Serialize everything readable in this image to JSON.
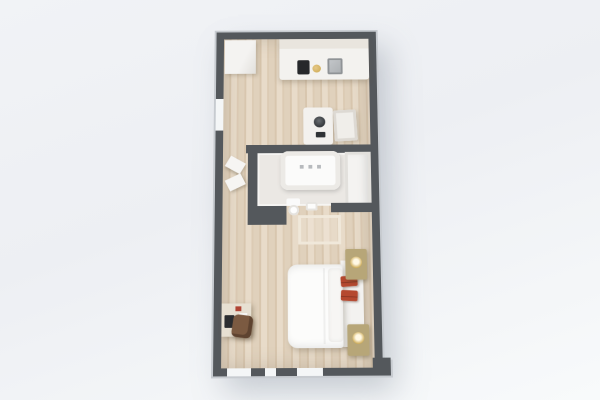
{
  "scene": {
    "title": "3D floor plan render",
    "type": "studio-apartment-top-down-3d",
    "view": "bird's-eye, slight perspective taper toward top"
  },
  "colors": {
    "bg": "#eff1f4",
    "wall": "#54585c",
    "wallEdge": "#c7cbd0",
    "wood": "#e0d1bc",
    "woodDark": "#d8c6ae",
    "woodLight": "#e8dbc9",
    "bathFloor": "#ebe8e4",
    "counter": "#f3f2ef",
    "cooktop": "#26282b",
    "appliance": "#a9adb0",
    "nightstand": "#b7a678",
    "lampGold": "#caa64e",
    "accentPillow": "#b5482f",
    "chairBrown": "#7b5a41"
  },
  "rooms": {
    "kitchen": {
      "name": "Kitchen / Dining",
      "items": [
        "tall wardrobe",
        "kitchen counter with upper cabinets",
        "black cooktop",
        "round brass sink",
        "stainless oven",
        "dining table with dark bowl",
        "white chair",
        "left wall window"
      ]
    },
    "bathroom": {
      "name": "Bathroom",
      "items": [
        "bathtub with faucet",
        "shower / storage unit",
        "toilet",
        "small sink",
        "open wardrobe doors in hall"
      ]
    },
    "bedroom": {
      "name": "Bedroom",
      "items": [
        "double bed with white duvet",
        "headboard",
        "two red accent pillows",
        "nightstand with gold lamp (top)",
        "nightstand with gold lamp (bottom)",
        "entry rug",
        "desk with laptop",
        "brown desk chair",
        "three bottom wall windows",
        "corner wall step"
      ]
    }
  }
}
